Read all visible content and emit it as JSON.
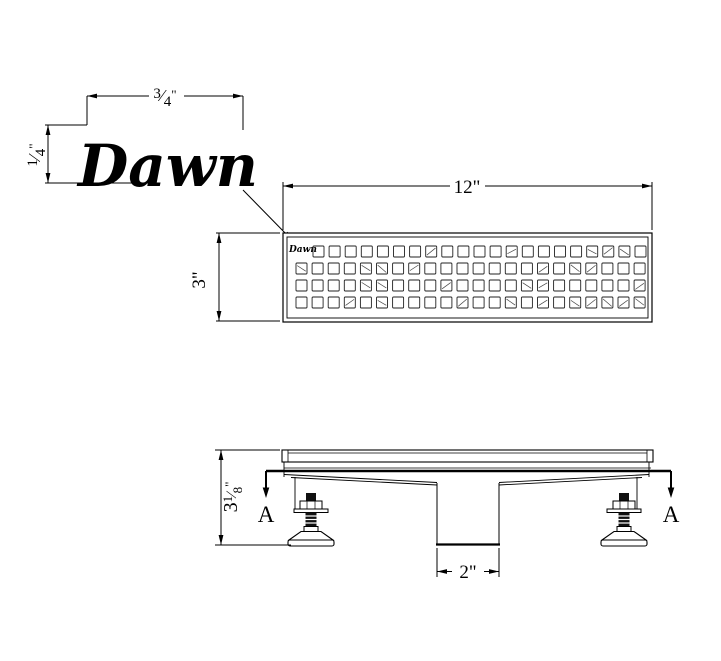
{
  "drawing": {
    "type": "technical-drawing",
    "product": "linear shower drain",
    "background": "#ffffff",
    "line_color": "#000000"
  },
  "brand": {
    "logo_text": "Dawn"
  },
  "views": {
    "top": {
      "plate_logo_text": "Dawn",
      "grid": {
        "rows": 4,
        "cols": 22,
        "row1_cols": 21,
        "size": 11,
        "pitch": 16.1,
        "row_pitch": 17,
        "x0": 296,
        "x0_row1": 313,
        "y0": 246
      }
    }
  },
  "dims": {
    "logo_width": {
      "num": "3",
      "slash": "⁄",
      "den": "4",
      "unit": "\""
    },
    "logo_height": {
      "num": "1",
      "slash": "⁄",
      "den": "4",
      "unit": "\""
    },
    "plate_width": "12\"",
    "plate_depth": "3\"",
    "body_height": {
      "whole": "3",
      "num": "1",
      "slash": "⁄",
      "den": "8",
      "unit": "\""
    },
    "outlet_width": "2\"",
    "section_label": "A"
  }
}
